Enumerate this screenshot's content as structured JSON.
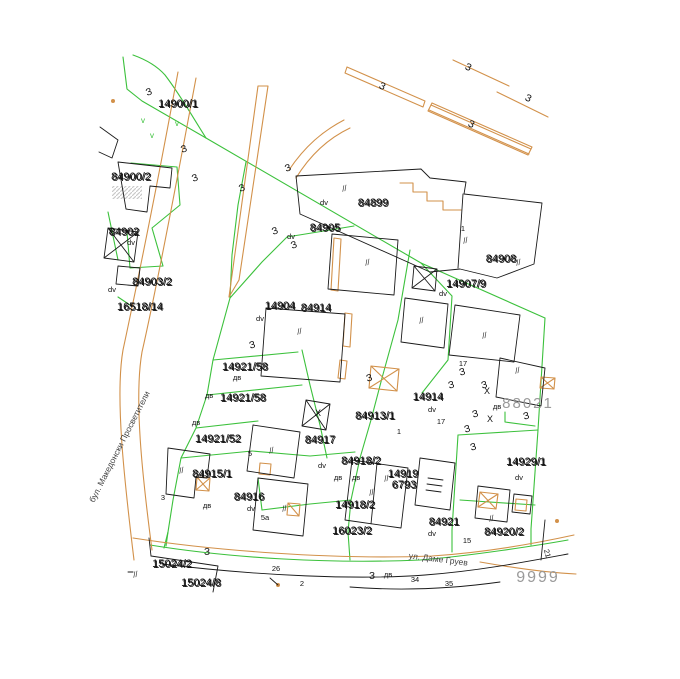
{
  "map": {
    "title": "cadastral parcel map",
    "colors": {
      "parcel_boundary_green": "#3cc13c",
      "road_orange": "#d2914a",
      "building_black": "#1a1a1a",
      "annotation_gray": "#9a9a9a",
      "label_text": "#111111"
    },
    "streets": [
      {
        "name": "бул. Македонски Просветители",
        "x": 122,
        "y": 448,
        "rot": -63
      },
      {
        "name": "ул. Даме Груев",
        "x": 438,
        "y": 562,
        "rot": 7
      }
    ],
    "gray_labels": [
      {
        "text": "88021",
        "x": 528,
        "y": 408,
        "size": 15
      },
      {
        "text": "9999",
        "x": 538,
        "y": 582,
        "size": 16
      }
    ],
    "parcel_labels": [
      {
        "text": "14900/1",
        "x": 178,
        "y": 107
      },
      {
        "text": "84900/2",
        "x": 131,
        "y": 180
      },
      {
        "text": "84902",
        "x": 124,
        "y": 235
      },
      {
        "text": "84903/2",
        "x": 152,
        "y": 285
      },
      {
        "text": "16518/14",
        "x": 140,
        "y": 310
      },
      {
        "text": "14904",
        "x": 280,
        "y": 309
      },
      {
        "text": "84914",
        "x": 316,
        "y": 311
      },
      {
        "text": "84905",
        "x": 325,
        "y": 231
      },
      {
        "text": "84899",
        "x": 373,
        "y": 206
      },
      {
        "text": "84908",
        "x": 501,
        "y": 262
      },
      {
        "text": "14907/9",
        "x": 466,
        "y": 287
      },
      {
        "text": "14914",
        "x": 428,
        "y": 400
      },
      {
        "text": "14921/58",
        "x": 245,
        "y": 370
      },
      {
        "text": "14921/58",
        "x": 243,
        "y": 401
      },
      {
        "text": "14921/52",
        "x": 218,
        "y": 442
      },
      {
        "text": "84915/1",
        "x": 212,
        "y": 477
      },
      {
        "text": "84916",
        "x": 249,
        "y": 500
      },
      {
        "text": "84917",
        "x": 320,
        "y": 443
      },
      {
        "text": "84913/1",
        "x": 375,
        "y": 419
      },
      {
        "text": "84918/2",
        "x": 361,
        "y": 464
      },
      {
        "text": "14919",
        "x": 403,
        "y": 477
      },
      {
        "text": "6793",
        "x": 404,
        "y": 488
      },
      {
        "text": "14918/2",
        "x": 355,
        "y": 508
      },
      {
        "text": "16023/2",
        "x": 352,
        "y": 534
      },
      {
        "text": "15024/2",
        "x": 172,
        "y": 567
      },
      {
        "text": "15024/8",
        "x": 201,
        "y": 586
      },
      {
        "text": "14929/1",
        "x": 526,
        "y": 465
      },
      {
        "text": "84921",
        "x": 444,
        "y": 525
      },
      {
        "text": "84920/2",
        "x": 504,
        "y": 535
      }
    ],
    "small_labels": [
      {
        "t": "dv",
        "x": 131,
        "y": 245
      },
      {
        "t": "dv",
        "x": 112,
        "y": 292
      },
      {
        "t": "dv",
        "x": 260,
        "y": 321
      },
      {
        "t": "dv",
        "x": 324,
        "y": 205
      },
      {
        "t": "dv",
        "x": 291,
        "y": 239
      },
      {
        "t": "dv",
        "x": 443,
        "y": 296
      },
      {
        "t": "dv",
        "x": 432,
        "y": 412
      },
      {
        "t": "дв",
        "x": 497,
        "y": 409
      },
      {
        "t": "dv",
        "x": 519,
        "y": 480
      },
      {
        "t": "dv",
        "x": 432,
        "y": 536
      },
      {
        "t": "dv",
        "x": 322,
        "y": 468
      },
      {
        "t": "dv",
        "x": 251,
        "y": 511
      },
      {
        "t": "дв",
        "x": 237,
        "y": 380
      },
      {
        "t": "дв",
        "x": 209,
        "y": 398
      },
      {
        "t": "дв",
        "x": 196,
        "y": 425
      },
      {
        "t": "дв",
        "x": 207,
        "y": 508
      },
      {
        "t": "дв",
        "x": 338,
        "y": 480
      },
      {
        "t": "дв",
        "x": 356,
        "y": 480
      },
      {
        "t": "дв",
        "x": 388,
        "y": 577
      },
      {
        "t": "17",
        "x": 463,
        "y": 366
      },
      {
        "t": "17",
        "x": 441,
        "y": 424
      },
      {
        "t": "5",
        "x": 250,
        "y": 456
      },
      {
        "t": "3",
        "x": 163,
        "y": 500
      },
      {
        "t": "5а",
        "x": 265,
        "y": 520
      },
      {
        "t": "15",
        "x": 467,
        "y": 543
      },
      {
        "t": "26",
        "x": 276,
        "y": 571
      },
      {
        "t": "2",
        "x": 302,
        "y": 586
      },
      {
        "t": "34",
        "x": 415,
        "y": 582
      },
      {
        "t": "35",
        "x": 449,
        "y": 586
      },
      {
        "t": "1",
        "x": 399,
        "y": 434
      },
      {
        "t": "1",
        "x": 463,
        "y": 231
      },
      {
        "t": "21",
        "x": 545,
        "y": 554,
        "r": 75
      }
    ],
    "ze_symbols": [
      {
        "x": 150,
        "y": 95,
        "r": -20
      },
      {
        "x": 185,
        "y": 152,
        "r": -20
      },
      {
        "x": 196,
        "y": 181,
        "r": -20
      },
      {
        "x": 243,
        "y": 191,
        "r": -20
      },
      {
        "x": 289,
        "y": 171,
        "r": -20
      },
      {
        "x": 276,
        "y": 234,
        "r": -20
      },
      {
        "x": 295,
        "y": 248,
        "r": -20
      },
      {
        "x": 381,
        "y": 89,
        "r": 25
      },
      {
        "x": 467,
        "y": 70,
        "r": 25
      },
      {
        "x": 527,
        "y": 101,
        "r": 25
      },
      {
        "x": 470,
        "y": 127,
        "r": 25
      },
      {
        "x": 253,
        "y": 348,
        "r": -15
      },
      {
        "x": 370,
        "y": 381,
        "r": -15
      },
      {
        "x": 463,
        "y": 375,
        "r": -15
      },
      {
        "x": 452,
        "y": 388,
        "r": -15
      },
      {
        "x": 485,
        "y": 388,
        "r": -15
      },
      {
        "x": 476,
        "y": 417,
        "r": -15
      },
      {
        "x": 527,
        "y": 419,
        "r": -15
      },
      {
        "x": 468,
        "y": 432,
        "r": -15
      },
      {
        "x": 474,
        "y": 450,
        "r": -15
      },
      {
        "x": 207,
        "y": 555,
        "r": 0
      },
      {
        "x": 372,
        "y": 579,
        "r": 0
      }
    ],
    "hatch_marks": [
      {
        "x": 345,
        "y": 191
      },
      {
        "x": 466,
        "y": 243
      },
      {
        "x": 368,
        "y": 265
      },
      {
        "x": 300,
        "y": 334
      },
      {
        "x": 422,
        "y": 323
      },
      {
        "x": 485,
        "y": 338
      },
      {
        "x": 518,
        "y": 373
      },
      {
        "x": 272,
        "y": 453
      },
      {
        "x": 182,
        "y": 473
      },
      {
        "x": 285,
        "y": 511
      },
      {
        "x": 372,
        "y": 495
      },
      {
        "x": 387,
        "y": 481
      },
      {
        "x": 492,
        "y": 521
      },
      {
        "x": 519,
        "y": 265
      },
      {
        "x": 136,
        "y": 577
      }
    ],
    "x_marks": [
      {
        "x": 318,
        "y": 416
      },
      {
        "x": 487,
        "y": 394
      },
      {
        "x": 490,
        "y": 422
      }
    ],
    "green_marks": [
      {
        "x": 143,
        "y": 123
      },
      {
        "x": 177,
        "y": 126
      },
      {
        "x": 152,
        "y": 138
      }
    ],
    "ze_glyph": "З",
    "hatch_glyph": "//",
    "x_glyph": "Х",
    "green_glyph": "v"
  }
}
